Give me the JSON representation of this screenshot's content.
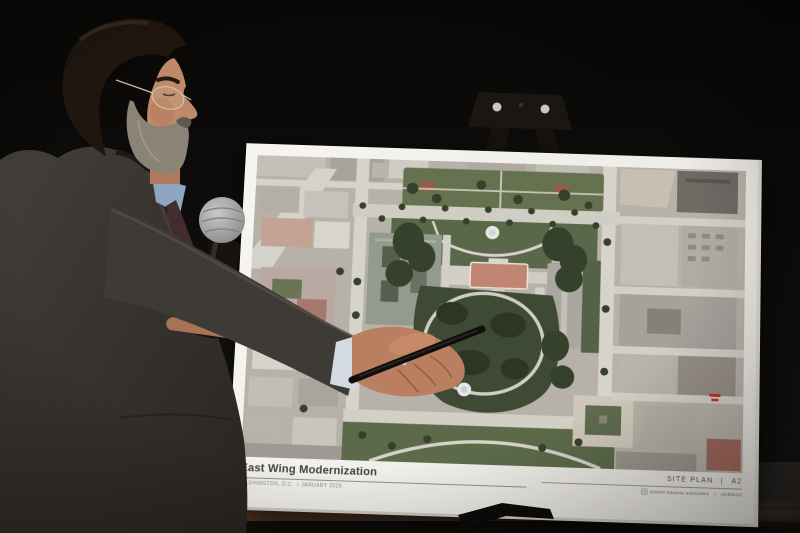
{
  "poster": {
    "title": "East Wing Modernization",
    "location": "WASHINGTON, D.C.",
    "date": "JANUARY 2026",
    "sheet_label": "SITE PLAN",
    "sheet_number": "A2",
    "firm_name": "shalom baranes associates",
    "firm_role": "architects"
  },
  "icons": {
    "firm_logo": "sb-monogram-square"
  },
  "colors": {
    "background_wall": "#0d0b0a",
    "poster_paper": "#f4f2ee",
    "map_ground": "#b6b2a9",
    "map_park_green": "#55624a",
    "map_lawn_dark_green": "#3e4a34",
    "map_street": "#d2cfc7",
    "white_house_roof": "#c08573",
    "annotation_red": "#c03226",
    "suit_gray": "#38342f",
    "shirt_blue": "#8fa6c2",
    "skin": "#bd8668",
    "microphone_head": "#a9a9a9",
    "ledge_gray": "#aba7a1",
    "wood_trim": "#6b482f"
  }
}
